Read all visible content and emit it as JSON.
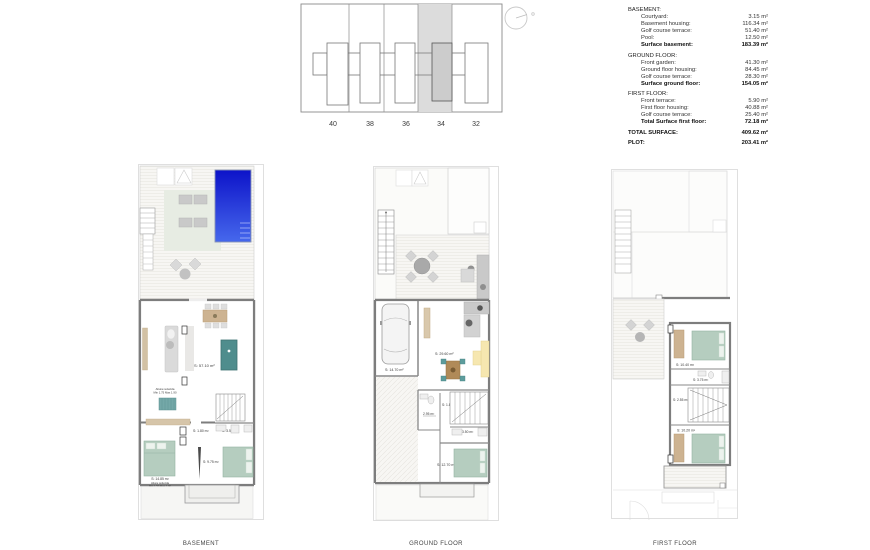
{
  "site_plan": {
    "plots": [
      "40",
      "38",
      "36",
      "34",
      "32"
    ],
    "highlighted_plot": "34"
  },
  "area_table": {
    "sections": [
      {
        "header": "BASEMENT:",
        "rows": [
          {
            "label": "Courtyard:",
            "value": "3.15 m²"
          },
          {
            "label": "Basement housing:",
            "value": "116.34 m²"
          },
          {
            "label": "Golf course terrace:",
            "value": "51.40 m²"
          },
          {
            "label": "Pool:",
            "value": "12.50 m²"
          }
        ],
        "total": {
          "label": "Surface basement:",
          "value": "183.39 m²"
        }
      },
      {
        "header": "GROUND FLOOR:",
        "rows": [
          {
            "label": "Front garden:",
            "value": "41.30 m²"
          },
          {
            "label": "Ground floor housing:",
            "value": "84.45 m²"
          },
          {
            "label": "Golf course terrace:",
            "value": "28.30 m²"
          }
        ],
        "total": {
          "label": "Surface ground floor:",
          "value": "154.05 m²"
        }
      },
      {
        "header": "FIRST FLOOR:",
        "rows": [
          {
            "label": "Front terrace:",
            "value": "5.90 m²"
          },
          {
            "label": "First floor housing:",
            "value": "40.88 m²"
          },
          {
            "label": "Golf course terrace:",
            "value": "25.40 m²"
          }
        ],
        "total": {
          "label": "Total Surface first floor:",
          "value": "72.18 m²"
        }
      }
    ],
    "grand_totals": [
      {
        "label": "TOTAL SURFACE:",
        "value": "409.62 m²"
      },
      {
        "label": "PLOT:",
        "value": "203.41 m²"
      }
    ]
  },
  "plans": {
    "basement": {
      "label": "BASEMENT",
      "areas": {
        "living": "S: 57.10 m²",
        "wc": "S: 1.80 m²",
        "bath": "S: 3.50 m²",
        "hall": "S: 9.75 m²",
        "bedroom": "S: 14.85 m²"
      },
      "notes": {
        "n1a": "Altura reducida",
        "n1b": "Min 1.75 Max 1.90",
        "n2a": "Altura reducida",
        "n2b": "Min 1.50 Max 1.90"
      }
    },
    "ground_floor": {
      "label": "GROUND FLOOR",
      "areas": {
        "garage": "S: 14.70 m²",
        "living": "S: 29.60 m²",
        "wc": "S: 1.80 m²",
        "hall": "2.95 m²",
        "bath": "S: 3.50 m²",
        "bedroom": "S: 12.70 m²"
      }
    },
    "first_floor": {
      "label": "FIRST FLOOR",
      "areas": {
        "bedroom1": "S: 10.40 m²",
        "bath": "S: 3.75 m²",
        "hall": "S: 2.55 m²",
        "bedroom2": "S: 10.20 m²"
      }
    }
  },
  "colors": {
    "pool_top": "#0d13c9",
    "pool_bottom": "#4668ec",
    "bed_green": "#b5cdbf",
    "deck_green": "#e7ece3",
    "teal": "#5d9c9c",
    "beige": "#cdb391",
    "plot_highlight": "#dcdcdc",
    "wall": "#7d7d7d"
  }
}
